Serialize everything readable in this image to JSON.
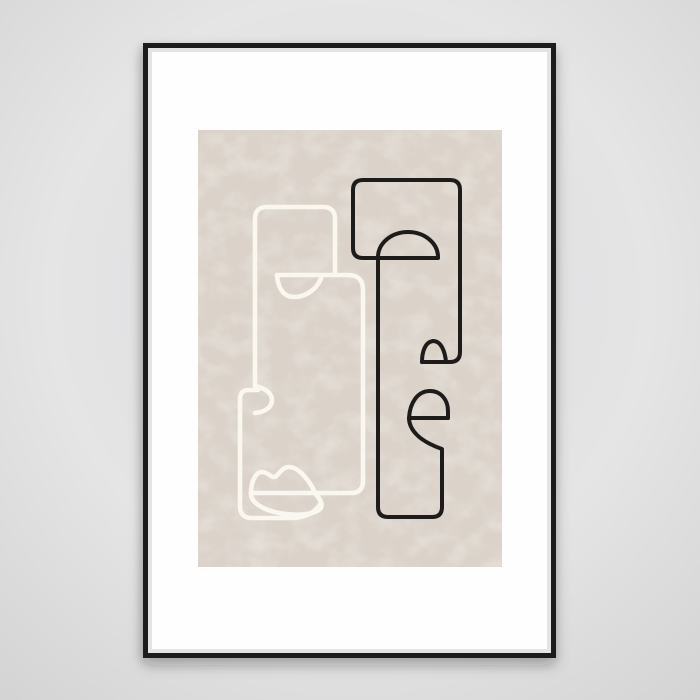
{
  "scene": {
    "label": "Abstract one-line faces art print in a thin black frame with white mat, hanging on a light gray wall",
    "wall_color": "#e5e5e6",
    "frame_color": "#1a1b1d",
    "mat_color": "#fefefe",
    "artwork_background": "#dbd3ca",
    "black_line_color": "#1d1c1a",
    "white_line_color": "#faf7f1"
  }
}
